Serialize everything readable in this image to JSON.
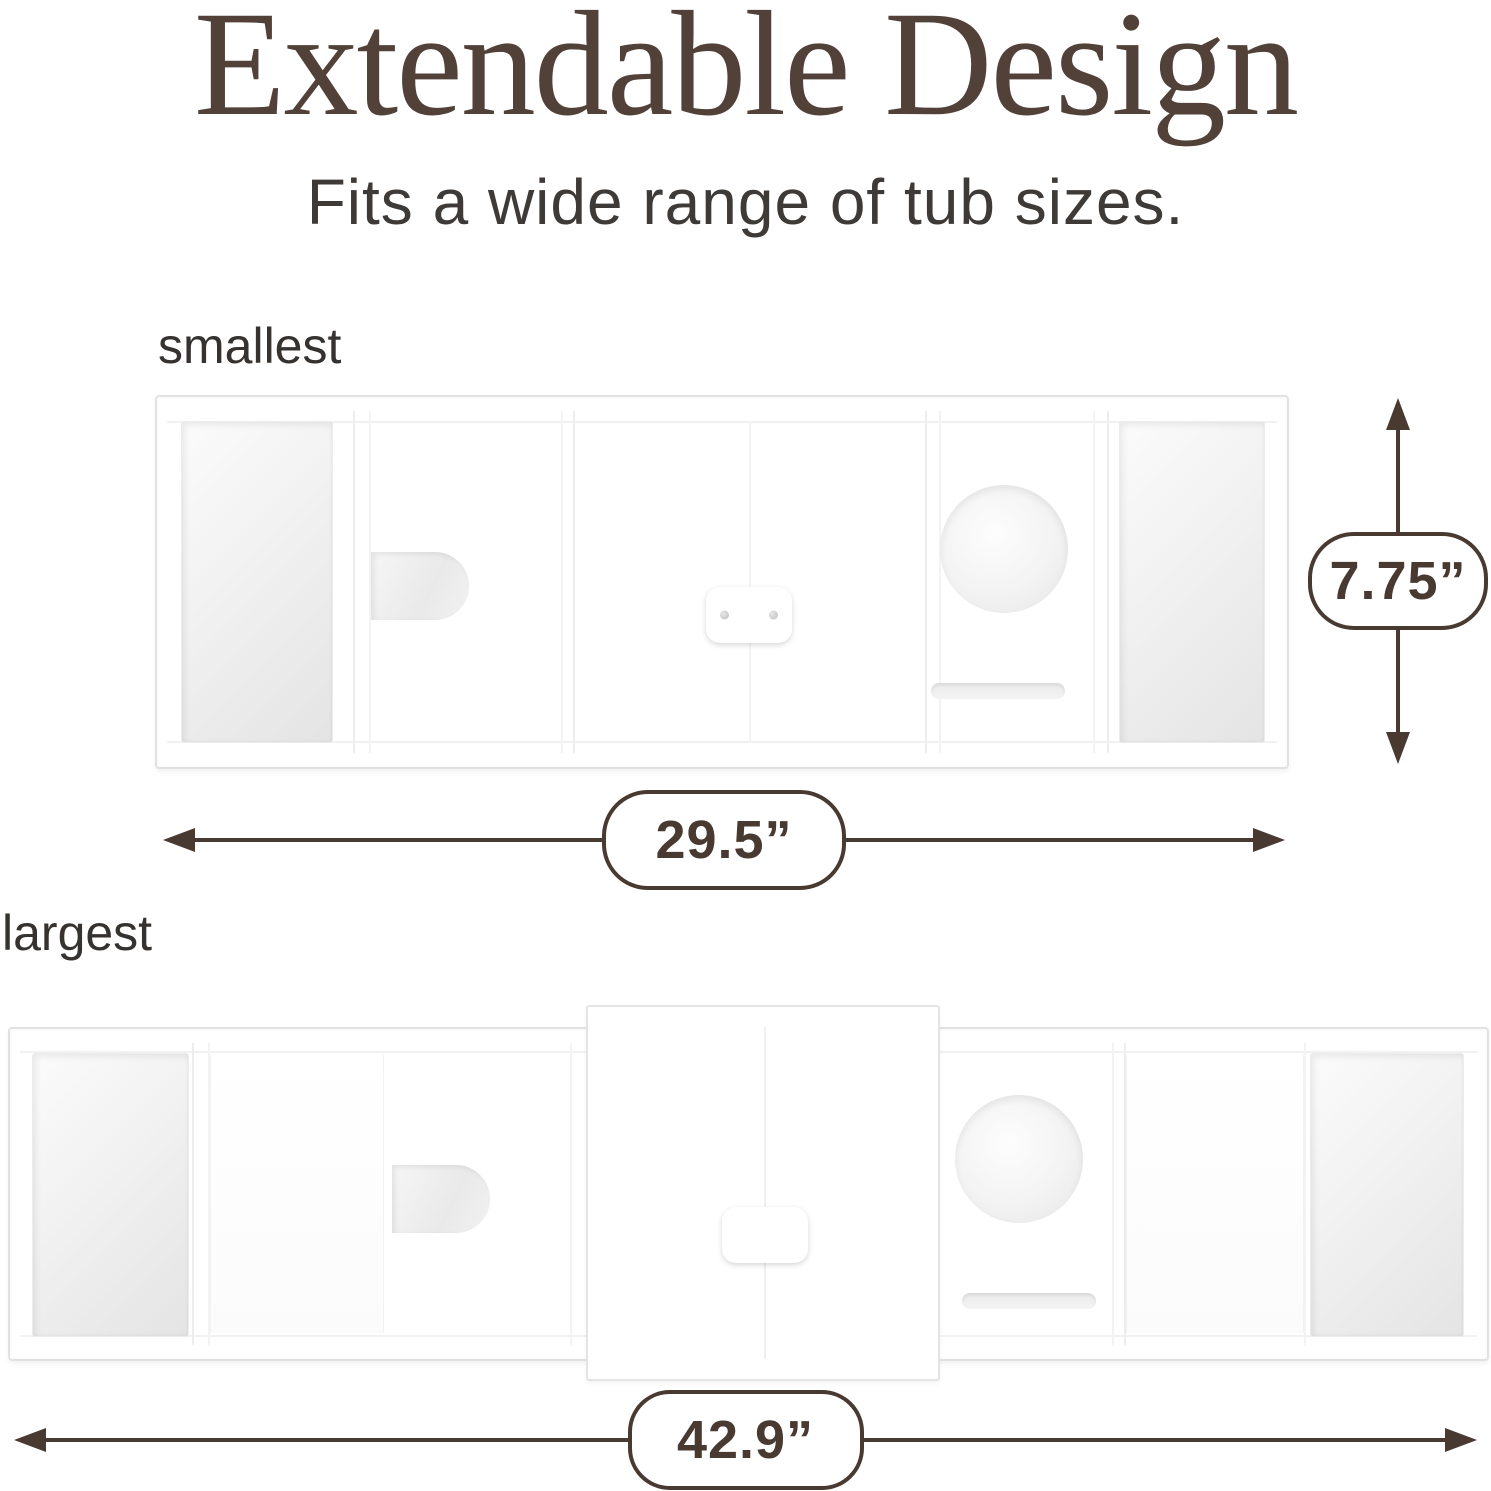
{
  "header": {
    "title": "Extendable Design",
    "subtitle": "Fits a wide range of tub sizes."
  },
  "colors": {
    "accent": "#483931",
    "title_text": "#524138",
    "label_text": "#35322f"
  },
  "diagrams": {
    "smallest": {
      "label": "smallest",
      "width": "29.5”",
      "height": "7.75”"
    },
    "largest": {
      "label": "largest",
      "width": "42.9”"
    }
  }
}
